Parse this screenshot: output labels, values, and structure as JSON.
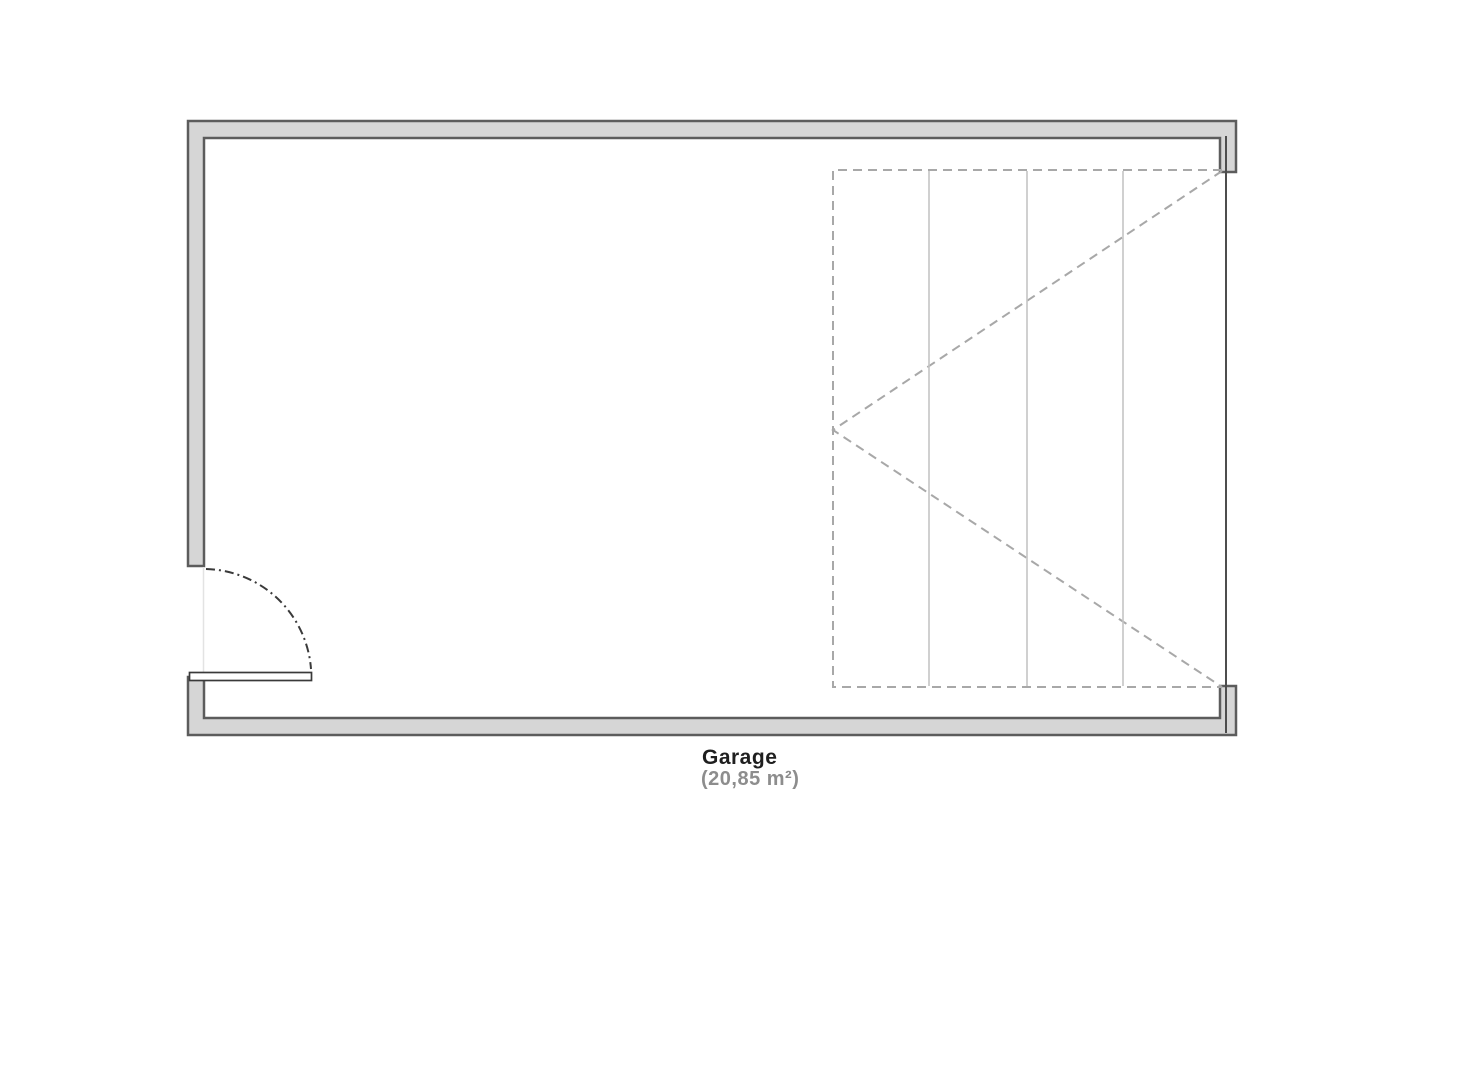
{
  "page": {
    "background_color": "#ffffff"
  },
  "plan": {
    "room_label": "Garage",
    "room_area": "(20,85 m²)",
    "symbols": {
      "entry_door": "swing-door-bottom-left",
      "garage_door": "sectional-door-panel-right"
    },
    "colors": {
      "wall_fill": "#d6d6d6",
      "wall_outline": "#5c5c5c",
      "opening_line": "#4d4d4d",
      "dashed_symbol": "#a8a8a8",
      "track_line": "#c5c5c5",
      "door_line": "#3a3a3a",
      "faint_opening": "#e3e3e3",
      "label_color": "#1f1f1f",
      "area_color": "#8d8d8d"
    }
  }
}
